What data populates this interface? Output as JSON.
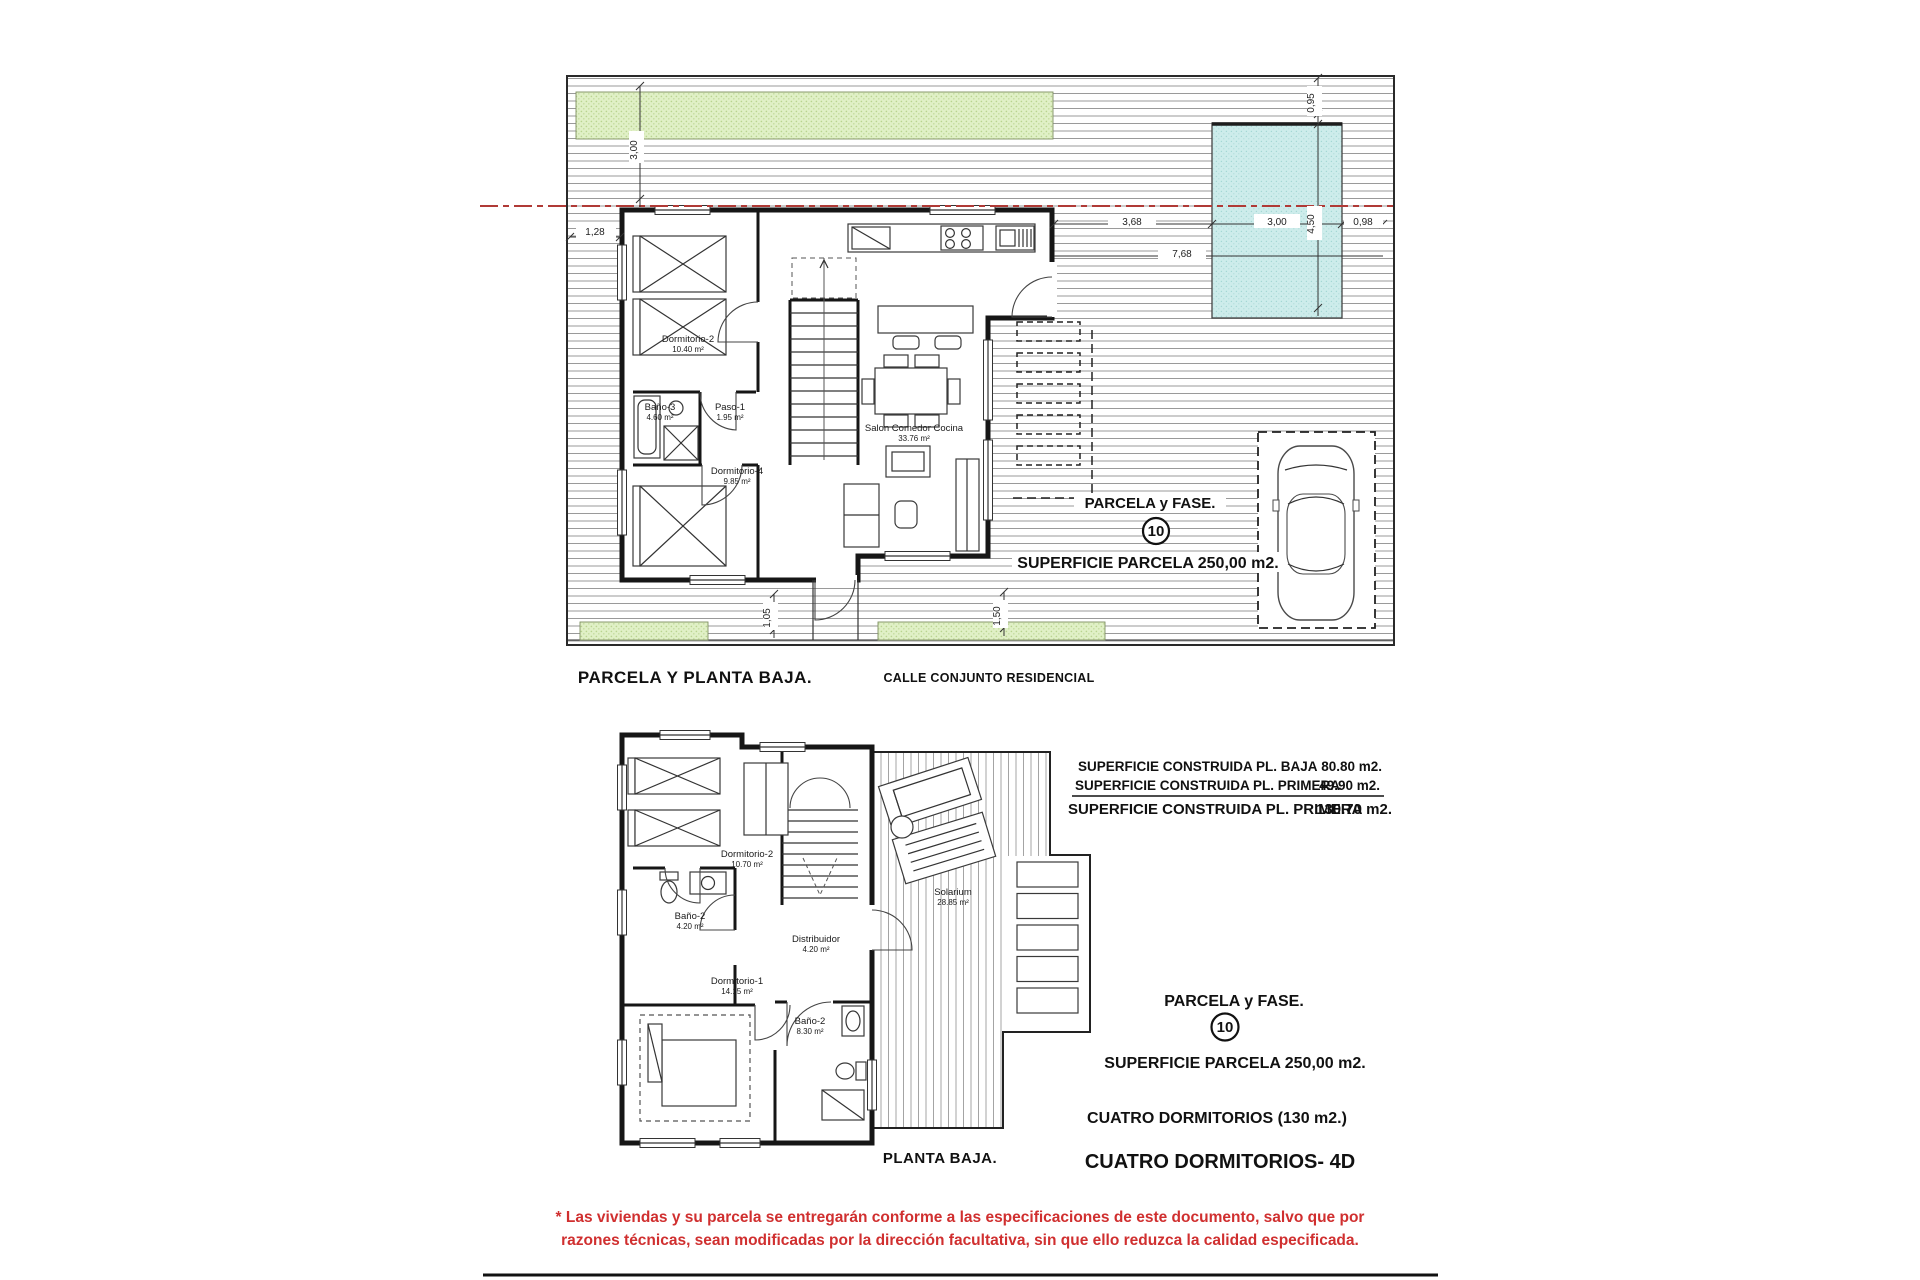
{
  "top_plan": {
    "title": "PARCELA Y PLANTA BAJA.",
    "street_label": "CALLE CONJUNTO RESIDENCIAL",
    "parcela_label": "PARCELA y FASE.",
    "parcela_number": "10",
    "superficie_label": "SUPERFICIE PARCELA 250,00 m2.",
    "rooms": [
      {
        "name": "Dormitorio-2",
        "area": "10.40 m²"
      },
      {
        "name": "Baño-3",
        "area": "4.60 m²"
      },
      {
        "name": "Paso-1",
        "area": "1.95 m²"
      },
      {
        "name": "Dormitorio-4",
        "area": "9.85 m²"
      },
      {
        "name": "Salon  Comedor  Cocina",
        "area": "33.76 m²"
      }
    ],
    "dims": {
      "left_vertical": "3,00",
      "left_house": "1,28",
      "pool_top": "0,95",
      "pool_height": "4,50",
      "pool_width": "3,00",
      "pool_right": "0,98",
      "house_to_pool": "3,68",
      "house_to_edge": "7,68",
      "bottom_left": "1,05",
      "bottom_right": "1,50"
    }
  },
  "bottom_plan": {
    "title": "PLANTA BAJA.",
    "rooms": [
      {
        "name": "Dormitorio-2",
        "area": "10.70 m²"
      },
      {
        "name": "Baño-2",
        "area": "4.20 m²"
      },
      {
        "name": "Distribuidor",
        "area": "4.20 m²"
      },
      {
        "name": "Dormitorio-1",
        "area": "14.15 m²"
      },
      {
        "name": "Baño-2",
        "area": "8.30 m²"
      },
      {
        "name": "Solarium",
        "area": "28.85 m²"
      }
    ]
  },
  "areas_table": {
    "rows": [
      {
        "label": "SUPERFICIE CONSTRUIDA PL. BAJA",
        "value": "80.80 m2."
      },
      {
        "label": "SUPERFICIE CONSTRUIDA PL. PRIMERA",
        "value": "49.90 m2."
      },
      {
        "label": "SUPERFICIE CONSTRUIDA PL. PRIMERA",
        "value": "130.70  m2."
      }
    ]
  },
  "summary": {
    "parcela_label": "PARCELA y FASE.",
    "parcela_number": "10",
    "superficie": "SUPERFICIE PARCELA 250,00 m2.",
    "tipologia": "CUATRO DORMITORIOS (130 m2.)",
    "modelo": "CUATRO DORMITORIOS- 4D"
  },
  "disclaimer": {
    "line1": "* Las viviendas y su parcela se entregarán conforme a las especificaciones de este documento, salvo que por",
    "line2": "razones técnicas, sean modificadas por la dirección facultativa, sin que ello reduzca la calidad especificada."
  },
  "colors": {
    "green_area": "#dfefc5",
    "pool": "#cdeceb",
    "boundary_red": "#b03a36",
    "disclaimer_red": "#d02f2f",
    "ink": "#161616"
  }
}
